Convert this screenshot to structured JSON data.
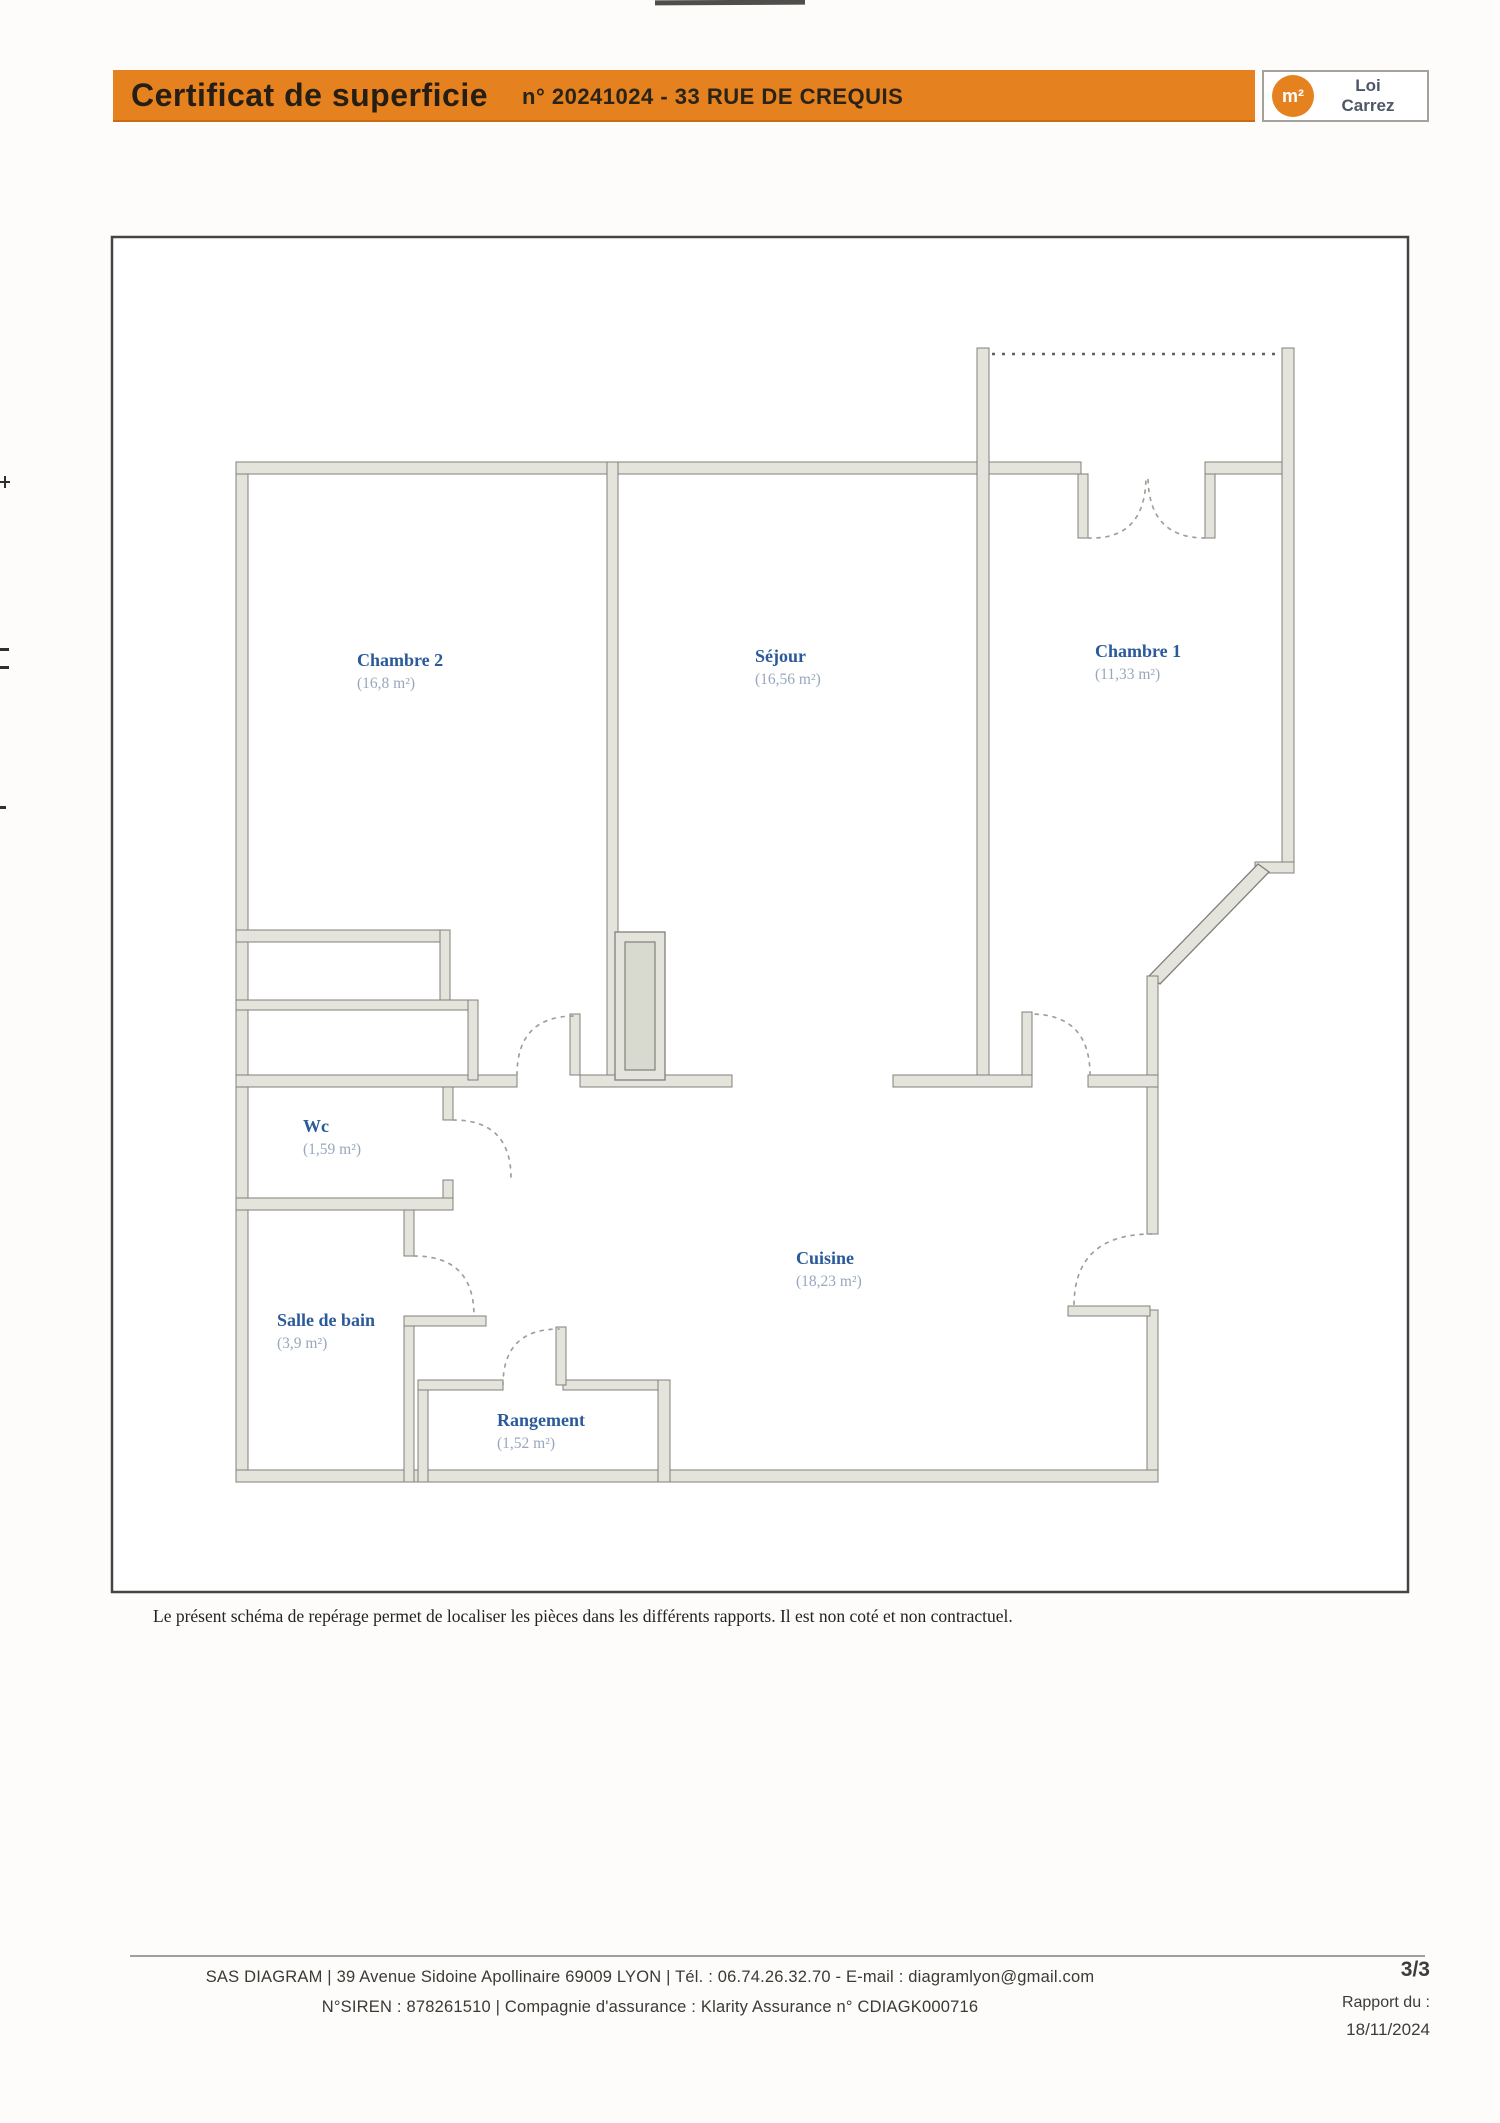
{
  "header": {
    "title": "Certificat de superficie",
    "subtitle": "n° 20241024 - 33 RUE DE CREQUIS",
    "accent_color": "#e5811f",
    "logo": {
      "symbol": "m²",
      "label_line1": "Loi",
      "label_line2": "Carrez"
    }
  },
  "plan": {
    "rooms": [
      {
        "name": "Chambre 2",
        "area": "(16,8 m²)"
      },
      {
        "name": "Séjour",
        "area": "(16,56 m²)"
      },
      {
        "name": "Chambre 1",
        "area": "(11,33 m²)"
      },
      {
        "name": "Wc",
        "area": "(1,59 m²)"
      },
      {
        "name": "Salle de bain",
        "area": "(3,9 m²)"
      },
      {
        "name": "Cuisine",
        "area": "(18,23 m²)"
      },
      {
        "name": "Rangement",
        "area": "(1,52 m²)"
      }
    ],
    "caption": "Le présent schéma de repérage permet de localiser les pièces dans les différents rapports. Il est non coté et non contractuel.",
    "colors": {
      "room_name": "#2b5a99",
      "room_area": "#98a7bc",
      "wall_fill": "#e4e4dc",
      "wall_line": "#80807a"
    }
  },
  "footer": {
    "line1": "SAS DIAGRAM | 39 Avenue Sidoine Apollinaire 69009 LYON | Tél. : 06.74.26.32.70 - E-mail : diagramlyon@gmail.com",
    "line2": "N°SIREN : 878261510 | Compagnie d'assurance : Klarity Assurance n° CDIAGK000716",
    "page_number": "3/3",
    "report_label": "Rapport du :",
    "report_date": "18/11/2024"
  }
}
